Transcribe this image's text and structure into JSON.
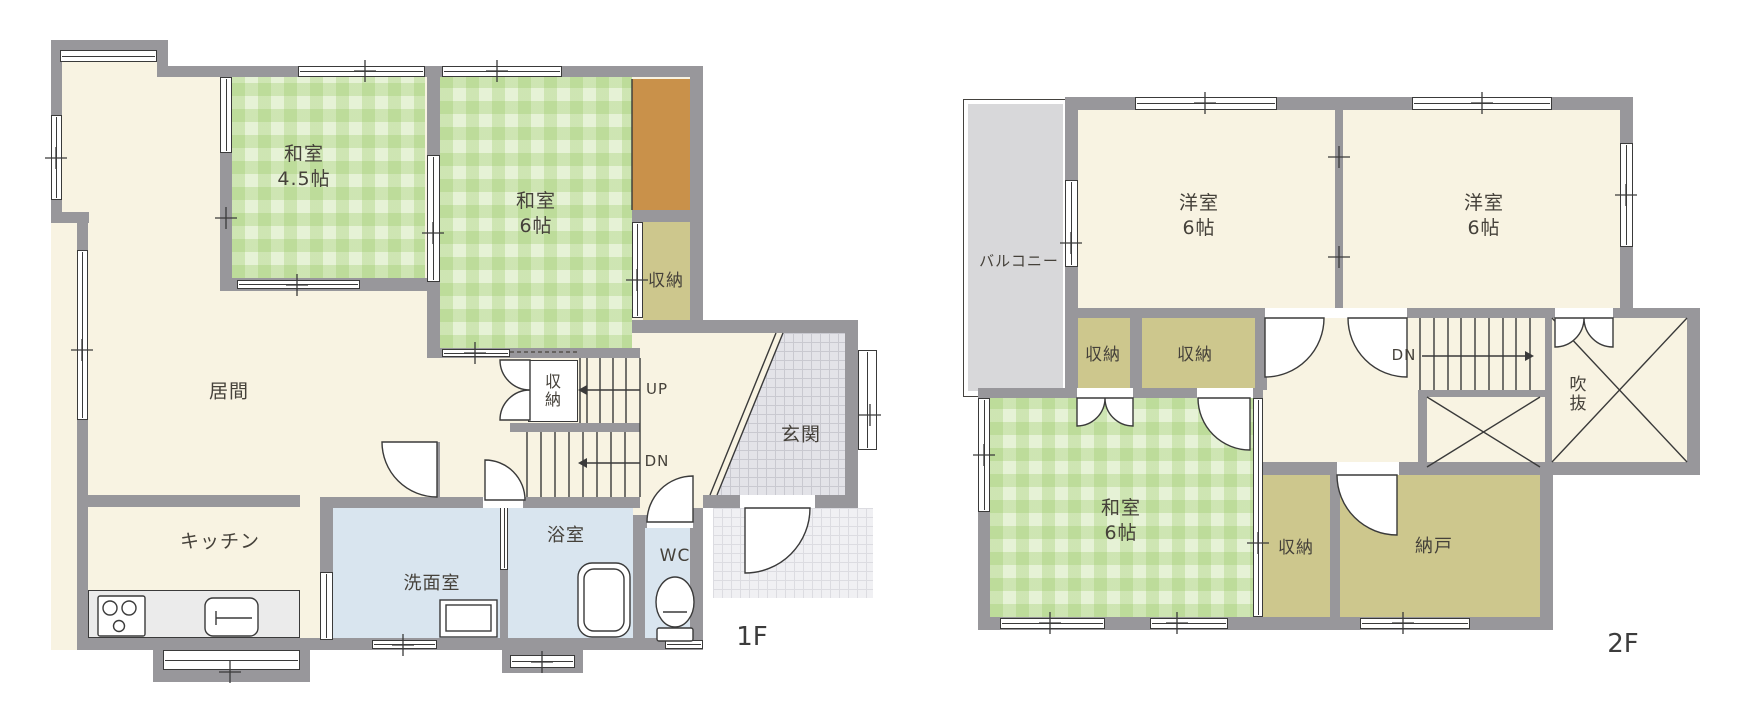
{
  "floor1": {
    "floor_label": "1F",
    "rooms": {
      "washitsu_45": {
        "name": "和室",
        "size": "4.5帖"
      },
      "washitsu_6": {
        "name": "和室",
        "size": "6帖"
      },
      "closet_right": {
        "label": "収納"
      },
      "stair_closet": {
        "label": "収納"
      },
      "living": {
        "label": "居間"
      },
      "kitchen": {
        "label": "キッチン"
      },
      "washroom": {
        "label": "洗面室"
      },
      "bathroom": {
        "label": "浴室"
      },
      "toilet": {
        "label": "WC"
      },
      "entrance": {
        "label": "玄関"
      }
    },
    "stairs": {
      "up": "UP",
      "down": "DN"
    }
  },
  "floor2": {
    "floor_label": "2F",
    "rooms": {
      "balcony": {
        "label": "バルコニー"
      },
      "yoshitsu_left": {
        "name": "洋室",
        "size": "6帖"
      },
      "yoshitsu_right": {
        "name": "洋室",
        "size": "6帖"
      },
      "closet_a": {
        "label": "収納"
      },
      "closet_b": {
        "label": "収納"
      },
      "closet_c": {
        "label": "収納"
      },
      "washitsu_6": {
        "name": "和室",
        "size": "6帖"
      },
      "storeroom": {
        "label": "納戸"
      },
      "void": {
        "label": "吹抜"
      }
    },
    "stairs": {
      "down": "DN"
    }
  },
  "colors": {
    "wall": "#98979b",
    "floor_cream": "#f8f3e2",
    "tatami_green": "#e6f2d6",
    "closet_olive": "#cdc78d",
    "tokonoma_orange": "#c9914a",
    "wet_area_blue": "#d9e5ef",
    "balcony_gray": "#d8d8da",
    "entrance_tile": "#e3e3e8",
    "porch_tile": "#f0f0f3",
    "line": "#3a3a3a"
  }
}
